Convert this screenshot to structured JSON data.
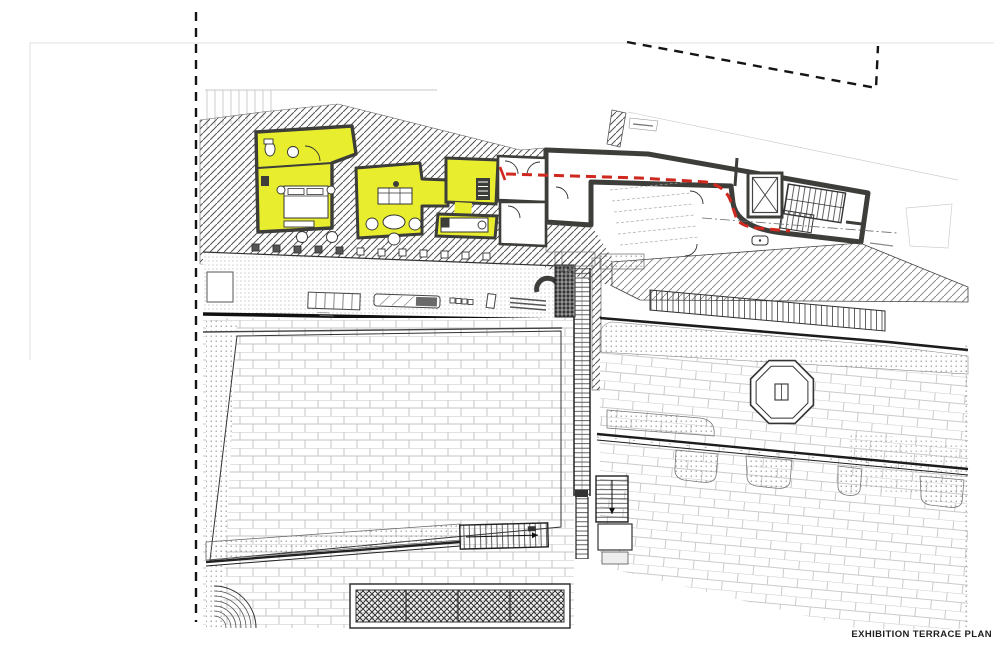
{
  "title": {
    "label": "EXHIBITION TERRACE PLAN"
  },
  "plan": {
    "highlighted_suite": "yellow highlighted exhibition rooms",
    "route_style": "red dashed visitor route",
    "boundary_style": "black dashed site boundary"
  },
  "colors": {
    "paper": "#ffffff",
    "line": "#1f1f1f",
    "wall": "#3d3d3a",
    "highlight": "#e8ee2e",
    "route": "#d0281e",
    "hatch": "#555555",
    "brick_joint": "#c6c6c6",
    "dot": "#8f8f8f",
    "faint": "#e0e0e0"
  }
}
